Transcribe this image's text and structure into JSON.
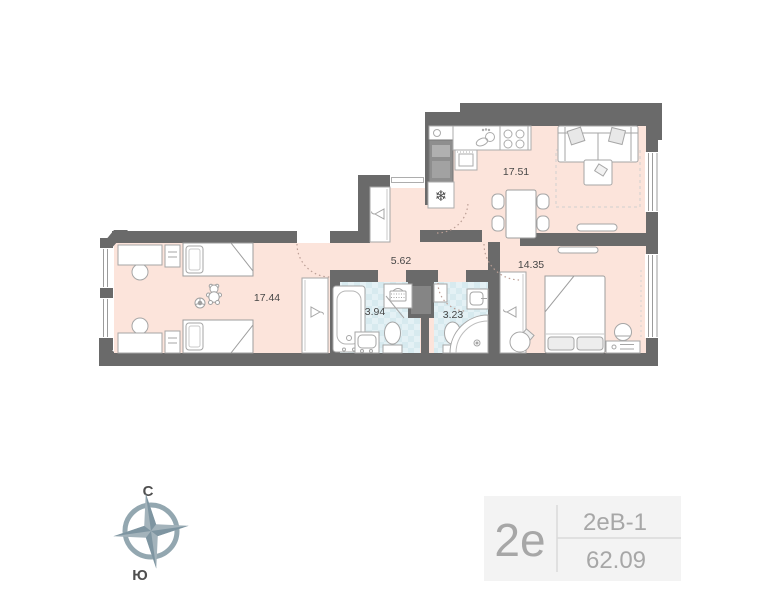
{
  "plan": {
    "rooms": [
      {
        "name": "kitchen-living-room",
        "area": "17.51"
      },
      {
        "name": "bedroom",
        "area": "14.35"
      },
      {
        "name": "children-room",
        "area": "17.44"
      },
      {
        "name": "hallway",
        "area": "5.62"
      },
      {
        "name": "bathroom",
        "area": "3.94"
      },
      {
        "name": "wc-shower",
        "area": "3.23"
      }
    ],
    "icons": {
      "fridge_snowflake": "❄"
    }
  },
  "compass": {
    "north_label": "С",
    "south_label": "Ю"
  },
  "unit_badge": {
    "plan_code": "2е",
    "layout_code": "2еВ-1",
    "total_area": "62.09"
  },
  "colors": {
    "wall": "#6a6a6a",
    "room_fill": "#fce4db",
    "tile_fill": "#d7eaef",
    "furniture_stroke": "#a6a6a6",
    "door_arc": "#bb9e95",
    "badge_bg": "#f3f3f3",
    "badge_text": "#a7a7a7",
    "compass_blue": "#93a7b0",
    "label_text": "#474747"
  }
}
